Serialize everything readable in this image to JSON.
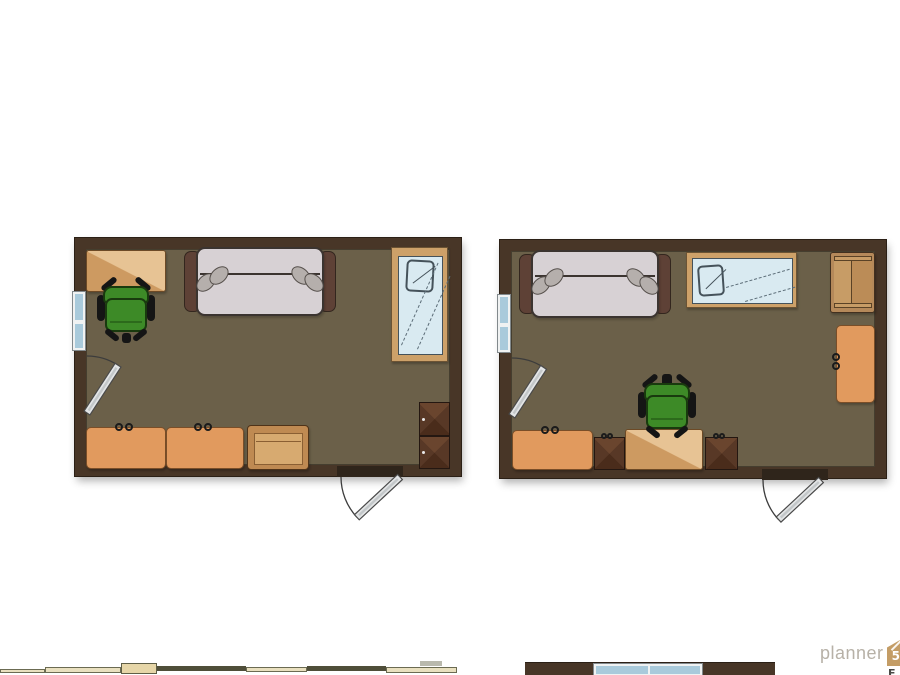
{
  "app": {
    "watermark_text": "planner",
    "watermark_badge": "5d",
    "cropped_glyph": "E"
  },
  "palette": {
    "wall": "#483627",
    "wallEdge": "#2b2016",
    "floor": "#6b6049",
    "deskBase": "#cd9a61",
    "deskLight": "#e7c394",
    "deskBorder": "#6d4a26",
    "dresser": "#e19a5e",
    "dresserBorder": "#7a4e28",
    "knob": "#1b1b1b",
    "nightOuter": "#bf8a52",
    "nightInner": "#d7aa70",
    "nightBorder": "#4f3319",
    "nightLine": "#8a5f33",
    "darkCabTop": "#6a452e",
    "darkCabSide": "#583826",
    "darkCabBottom": "#4a2c1b",
    "darkCabBorder": "#241711",
    "sofaArm": "#5e4136",
    "sofaArmBorder": "#33261e",
    "sofaBody": "#d7d1d4",
    "sofaBorder": "#3b3430",
    "cushion": "#b5afac",
    "cushionBorder": "#554f4b",
    "glass": "#d9eaf1",
    "mirrorFrame": "#cda169",
    "mirrorBorder": "#6b5334",
    "sketch": "#45525a",
    "reflection": "#5c6d78",
    "winFrame": "#f0f2f2",
    "winBorder": "#82898c",
    "winGlass": "#a9cadb",
    "chairGreen": "#3d8a27",
    "chairDark": "#193a0e",
    "chairLine": "#2c6a1b",
    "black": "#151515",
    "doorLeaf": "#e3e5e6",
    "doorLeafCore": "#c3c7c9",
    "doorStroke": "#4a4a4a",
    "arc": "#3c3c3c",
    "threshold": "#2f251b",
    "shelfOuter": "#b5895a",
    "shelfPanelL": "#c79c66",
    "shelfPanelR": "#bb8c57",
    "shelfBorder": "#42301f",
    "shelfLine": "#5a4226",
    "logoText": "#b7b1a7",
    "logoBadge": "#c49d66",
    "croppedGlyph": "#4a4a46",
    "stripCream": "#e9e0bf",
    "stripCreamBorder": "#6b6b52",
    "stripTan": "#e6d6a8",
    "stripTanBorder": "#5e5e46",
    "stripDark": "#4f4e39",
    "stripGray": "#b9b9ad"
  },
  "rooms": [
    {
      "name": "room-left",
      "x": 75,
      "y": 238,
      "w": 386,
      "h": 238,
      "wall": 11,
      "items": [
        {
          "kind": "desk",
          "name": "desk",
          "x": 86,
          "y": 250,
          "w": 80,
          "h": 42
        },
        {
          "kind": "office-chair",
          "name": "office-chair",
          "x": 96,
          "y": 277,
          "w": 60,
          "h": 64,
          "tab": false,
          "stub": true
        },
        {
          "kind": "sofa",
          "name": "sofa",
          "x": 184,
          "y": 247,
          "w": 152,
          "h": 69
        },
        {
          "kind": "mirror",
          "name": "wall-mirror",
          "x": 391,
          "y": 247,
          "w": 57,
          "h": 115,
          "orient": "v"
        },
        {
          "kind": "window",
          "name": "window",
          "x": 72,
          "y": 291,
          "w": 14,
          "h": 60,
          "orient": "v"
        },
        {
          "kind": "dresser",
          "name": "dresser",
          "x": 86,
          "y": 427,
          "w": 80,
          "h": 42,
          "knobs": "top"
        },
        {
          "kind": "dresser",
          "name": "dresser",
          "x": 166,
          "y": 427,
          "w": 78,
          "h": 42,
          "knobs": "top"
        },
        {
          "kind": "nightstand",
          "name": "nightstand",
          "x": 247,
          "y": 425,
          "w": 62,
          "h": 45
        },
        {
          "kind": "dark-cabinet",
          "name": "corner-cabinet",
          "x": 419,
          "y": 402,
          "w": 31,
          "h": 67,
          "cells": 2,
          "knobs": "left-dots"
        },
        {
          "kind": "threshold",
          "name": "door-opening",
          "x": 337,
          "y": 466,
          "w": 66,
          "h": 11
        },
        {
          "kind": "door",
          "name": "exterior-door",
          "hx": 400,
          "hy": 477,
          "len": 59,
          "closed": 270,
          "open": 227
        },
        {
          "kind": "door",
          "name": "interior-door",
          "hx": 87,
          "hy": 413,
          "len": 57,
          "closed": 0,
          "open": 33
        }
      ]
    },
    {
      "name": "room-right",
      "x": 500,
      "y": 240,
      "w": 386,
      "h": 238,
      "wall": 11,
      "items": [
        {
          "kind": "sofa",
          "name": "sofa",
          "x": 519,
          "y": 250,
          "w": 152,
          "h": 68
        },
        {
          "kind": "mirror",
          "name": "wall-mirror",
          "x": 686,
          "y": 252,
          "w": 111,
          "h": 56,
          "orient": "h"
        },
        {
          "kind": "shelf",
          "name": "shelf-cabinet",
          "x": 830,
          "y": 252,
          "w": 45,
          "h": 61
        },
        {
          "kind": "dresser",
          "name": "dresser",
          "x": 836,
          "y": 325,
          "w": 39,
          "h": 78,
          "knobs": "left"
        },
        {
          "kind": "dresser",
          "name": "dresser",
          "x": 512,
          "y": 430,
          "w": 81,
          "h": 40,
          "knobs": "top"
        },
        {
          "kind": "dark-cabinet",
          "name": "cabinet",
          "x": 594,
          "y": 437,
          "w": 31,
          "h": 33,
          "cells": 1,
          "knobs": "top"
        },
        {
          "kind": "desk",
          "name": "desk",
          "x": 625,
          "y": 429,
          "w": 78,
          "h": 41
        },
        {
          "kind": "dark-cabinet",
          "name": "cabinet",
          "x": 705,
          "y": 437,
          "w": 33,
          "h": 33,
          "cells": 1,
          "knobs": "top"
        },
        {
          "kind": "office-chair",
          "name": "office-chair",
          "x": 637,
          "y": 374,
          "w": 60,
          "h": 64,
          "tab": true,
          "stub": false
        },
        {
          "kind": "window",
          "name": "window",
          "x": 497,
          "y": 294,
          "w": 14,
          "h": 59,
          "orient": "v"
        },
        {
          "kind": "threshold",
          "name": "door-opening",
          "x": 762,
          "y": 469,
          "w": 66,
          "h": 11
        },
        {
          "kind": "door",
          "name": "exterior-door",
          "hx": 821,
          "hy": 480,
          "len": 58,
          "closed": 270,
          "open": 227
        },
        {
          "kind": "door",
          "name": "interior-door",
          "hx": 512,
          "hy": 416,
          "len": 58,
          "closed": 0,
          "open": 33
        }
      ]
    }
  ],
  "bottom_strip": [
    {
      "name": "cropped-furniture",
      "x": 0,
      "y": 669,
      "w": 45,
      "h": 4,
      "tone": "cream"
    },
    {
      "name": "cropped-furniture",
      "x": 45,
      "y": 667,
      "w": 76,
      "h": 6,
      "tone": "cream"
    },
    {
      "name": "cropped-furniture",
      "x": 121,
      "y": 663,
      "w": 36,
      "h": 11,
      "tone": "tan"
    },
    {
      "name": "cropped-furniture",
      "x": 157,
      "y": 666,
      "w": 89,
      "h": 5,
      "tone": "dark"
    },
    {
      "name": "cropped-furniture",
      "x": 246,
      "y": 667,
      "w": 61,
      "h": 5,
      "tone": "cream"
    },
    {
      "name": "cropped-furniture",
      "x": 307,
      "y": 666,
      "w": 79,
      "h": 5,
      "tone": "dark"
    },
    {
      "name": "cropped-furniture",
      "x": 386,
      "y": 667,
      "w": 71,
      "h": 6,
      "tone": "cream"
    },
    {
      "name": "cropped-furniture",
      "x": 420,
      "y": 661,
      "w": 22,
      "h": 5,
      "tone": "gray"
    }
  ],
  "partial_room": {
    "wall": {
      "name": "cropped-room-wall",
      "x": 525,
      "y": 662,
      "w": 250,
      "h": 14
    },
    "window": {
      "name": "cropped-room-window",
      "x": 593,
      "y": 663,
      "w": 110,
      "h": 14
    }
  }
}
